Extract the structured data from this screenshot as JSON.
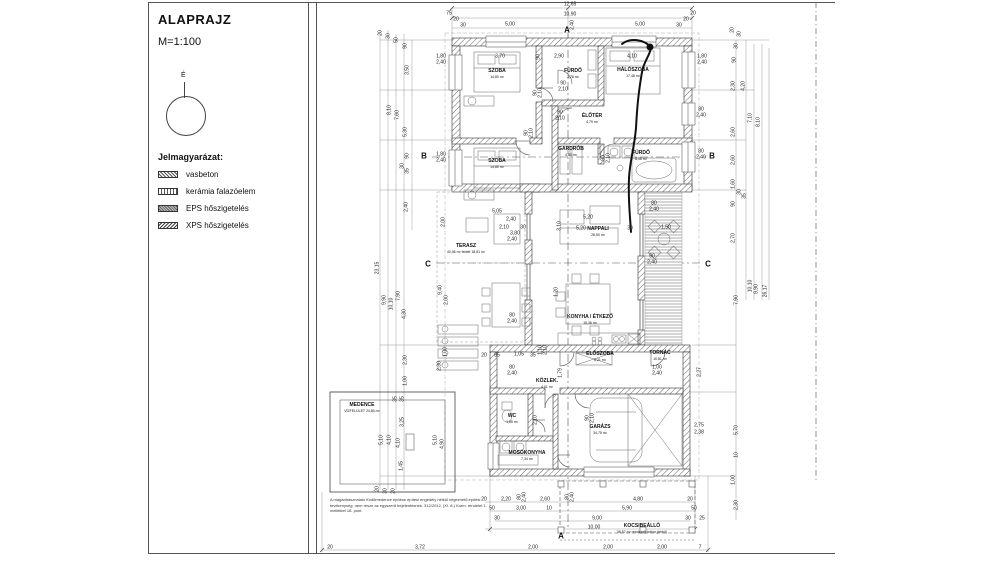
{
  "titleblock": {
    "title": "ALAPRAJZ",
    "scale": "M=1:100",
    "north_label": "É",
    "legend_title": "Jelmagyarázat:",
    "legend": [
      {
        "label": "vasbeton"
      },
      {
        "label": "kerámia falazóelem"
      },
      {
        "label": "EPS hőszigetelés"
      },
      {
        "label": "XPS hőszigetelés"
      }
    ]
  },
  "note": "A magánhasználatú fürdőmedence építése építési engedély nélkül végezhető építési tevékenység, nem része az egyszerű bejelentésnek. 312/2012. (XI. 8.) Korm. rendelet 1. melléklet 18. pont.",
  "rooms": [
    {
      "name": "SZOBA",
      "sub": "14,80 m²",
      "x": 497,
      "y": 74
    },
    {
      "name": "FÜRDŐ",
      "sub": "3,78 m²",
      "x": 573,
      "y": 74
    },
    {
      "name": "HÁLÓSZOBA",
      "sub": "17,48 m²",
      "x": 633,
      "y": 73
    },
    {
      "name": "ÉLŐTÉR",
      "sub": "4,79 m²",
      "x": 592,
      "y": 119
    },
    {
      "name": "GARDRÓB",
      "sub": "4,80 m²",
      "x": 571,
      "y": 152
    },
    {
      "name": "FÜRDŐ",
      "sub": "8,06 m²",
      "x": 641,
      "y": 156
    },
    {
      "name": "SZOBA",
      "sub": "14,80 m²",
      "x": 497,
      "y": 164
    },
    {
      "name": "TERASZ",
      "sub": "40,96 m²  fedett 18,81 m²",
      "x": 466,
      "y": 249
    },
    {
      "name": "NAPPALI",
      "sub": "28,50 m²",
      "x": 598,
      "y": 232
    },
    {
      "name": "KONYHA / ÉTKEZŐ",
      "sub": "15,36 m²",
      "x": 590,
      "y": 320
    },
    {
      "name": "ELŐSZOBA",
      "sub": "6,21 m²",
      "x": 600,
      "y": 357
    },
    {
      "name": "TORNÁC",
      "sub": "10,81 m²",
      "x": 660,
      "y": 356
    },
    {
      "name": "KÖZLEK.",
      "sub": "4,01 m²",
      "x": 547,
      "y": 384
    },
    {
      "name": "WC",
      "sub": "1,85 m²",
      "x": 512,
      "y": 419
    },
    {
      "name": "MOSÓKONYHA",
      "sub": "7,34 m²",
      "x": 527,
      "y": 456
    },
    {
      "name": "GARÁZS",
      "sub": "34,75 m²",
      "x": 600,
      "y": 430
    },
    {
      "name": "KOCSIBEÁLLÓ",
      "sub": "36,57 m²  rendezett beton (térkő)",
      "x": 642,
      "y": 529
    },
    {
      "name": "MEDENCE",
      "sub": "VÍZFELÜLET  24,80 m²",
      "x": 362,
      "y": 408
    }
  ],
  "sections": [
    {
      "label": "B",
      "x": 424,
      "y": 156
    },
    {
      "label": "B",
      "x": 712,
      "y": 156
    },
    {
      "label": "C",
      "x": 428,
      "y": 264
    },
    {
      "label": "C",
      "x": 708,
      "y": 264
    },
    {
      "label": "A",
      "x": 567,
      "y": 30
    },
    {
      "label": "A",
      "x": 561,
      "y": 536
    }
  ],
  "dimensions": [
    {
      "t": "12,65",
      "x": 570,
      "y": 5
    },
    {
      "t": "10,90",
      "x": 570,
      "y": 15
    },
    {
      "t": "5,00",
      "x": 510,
      "y": 25
    },
    {
      "t": "2,40",
      "x": 573,
      "y": 25,
      "v": 1
    },
    {
      "t": "5,00",
      "x": 640,
      "y": 25
    },
    {
      "t": "75",
      "x": 449,
      "y": 14
    },
    {
      "t": "20",
      "x": 456,
      "y": 20
    },
    {
      "t": "30",
      "x": 463,
      "y": 26
    },
    {
      "t": "30",
      "x": 679,
      "y": 26
    },
    {
      "t": "20",
      "x": 686,
      "y": 20
    },
    {
      "t": "20",
      "x": 693,
      "y": 14
    },
    {
      "t": "1,80",
      "x": 441,
      "y": 57
    },
    {
      "t": "2,40",
      "x": 441,
      "y": 63
    },
    {
      "t": "3,70",
      "x": 500,
      "y": 57
    },
    {
      "t": "90",
      "x": 539,
      "y": 57,
      "v": 1
    },
    {
      "t": "2,90",
      "x": 559,
      "y": 57
    },
    {
      "t": "4,10",
      "x": 632,
      "y": 57
    },
    {
      "t": "1,80",
      "x": 702,
      "y": 57
    },
    {
      "t": "2,40",
      "x": 702,
      "y": 63
    },
    {
      "t": "90",
      "x": 536,
      "y": 93,
      "v": 1
    },
    {
      "t": "2,10",
      "x": 541,
      "y": 93,
      "v": 1
    },
    {
      "t": "90",
      "x": 527,
      "y": 133,
      "v": 1
    },
    {
      "t": "2,10",
      "x": 532,
      "y": 133,
      "v": 1
    },
    {
      "t": "80",
      "x": 701,
      "y": 110
    },
    {
      "t": "2,40",
      "x": 701,
      "y": 116
    },
    {
      "t": "90",
      "x": 563,
      "y": 84
    },
    {
      "t": "2,10",
      "x": 563,
      "y": 90
    },
    {
      "t": "90",
      "x": 560,
      "y": 113
    },
    {
      "t": "2,10",
      "x": 560,
      "y": 119
    },
    {
      "t": "1,80",
      "x": 441,
      "y": 155
    },
    {
      "t": "2,40",
      "x": 441,
      "y": 161
    },
    {
      "t": "80",
      "x": 701,
      "y": 152
    },
    {
      "t": "2,40",
      "x": 701,
      "y": 158
    },
    {
      "t": "90",
      "x": 604,
      "y": 158,
      "v": 1
    },
    {
      "t": "2,10",
      "x": 609,
      "y": 158,
      "v": 1
    },
    {
      "t": "5,05",
      "x": 497,
      "y": 212
    },
    {
      "t": "2,40",
      "x": 511,
      "y": 220
    },
    {
      "t": "2,10",
      "x": 504,
      "y": 228
    },
    {
      "t": "30",
      "x": 523,
      "y": 228
    },
    {
      "t": "3,80",
      "x": 515,
      "y": 234
    },
    {
      "t": "2,40",
      "x": 512,
      "y": 240
    },
    {
      "t": "2,00",
      "x": 444,
      "y": 222,
      "v": 1
    },
    {
      "t": "9,40",
      "x": 441,
      "y": 290,
      "v": 1
    },
    {
      "t": "2,00",
      "x": 447,
      "y": 300,
      "v": 1
    },
    {
      "t": "1,00",
      "x": 446,
      "y": 352,
      "v": 1
    },
    {
      "t": "5,20",
      "x": 588,
      "y": 218
    },
    {
      "t": "5,20",
      "x": 581,
      "y": 229
    },
    {
      "t": "30",
      "x": 630,
      "y": 229
    },
    {
      "t": "3,10",
      "x": 560,
      "y": 226,
      "v": 1
    },
    {
      "t": "80",
      "x": 654,
      "y": 204
    },
    {
      "t": "2,40",
      "x": 654,
      "y": 210
    },
    {
      "t": "1,50",
      "x": 666,
      "y": 228
    },
    {
      "t": "90",
      "x": 652,
      "y": 257
    },
    {
      "t": "2,40",
      "x": 652,
      "y": 263
    },
    {
      "t": "80",
      "x": 512,
      "y": 316
    },
    {
      "t": "2,40",
      "x": 512,
      "y": 322
    },
    {
      "t": "1,20",
      "x": 557,
      "y": 292,
      "v": 1
    },
    {
      "t": "20",
      "x": 484,
      "y": 356
    },
    {
      "t": "85",
      "x": 497,
      "y": 356
    },
    {
      "t": "1,05",
      "x": 519,
      "y": 355
    },
    {
      "t": "35",
      "x": 533,
      "y": 356
    },
    {
      "t": "80",
      "x": 512,
      "y": 368
    },
    {
      "t": "2,40",
      "x": 512,
      "y": 374
    },
    {
      "t": "1,10",
      "x": 541,
      "y": 350,
      "v": 1
    },
    {
      "t": "2,10",
      "x": 546,
      "y": 350,
      "v": 1
    },
    {
      "t": "1,79",
      "x": 561,
      "y": 373,
      "v": 1
    },
    {
      "t": "1,00",
      "x": 657,
      "y": 368
    },
    {
      "t": "2,40",
      "x": 657,
      "y": 374
    },
    {
      "t": "2,27",
      "x": 700,
      "y": 372,
      "v": 1
    },
    {
      "t": "90",
      "x": 588,
      "y": 418,
      "v": 1
    },
    {
      "t": "2,10",
      "x": 593,
      "y": 418,
      "v": 1
    },
    {
      "t": "2,10",
      "x": 536,
      "y": 420,
      "v": 1
    },
    {
      "t": "2,75",
      "x": 699,
      "y": 426
    },
    {
      "t": "2,38",
      "x": 699,
      "y": 433
    },
    {
      "t": "20",
      "x": 484,
      "y": 500
    },
    {
      "t": "2,20",
      "x": 506,
      "y": 500
    },
    {
      "t": "80",
      "x": 520,
      "y": 497,
      "v": 1
    },
    {
      "t": "2,40",
      "x": 525,
      "y": 497,
      "v": 1
    },
    {
      "t": "2,60",
      "x": 545,
      "y": 500
    },
    {
      "t": "80",
      "x": 568,
      "y": 497,
      "v": 1
    },
    {
      "t": "2,40",
      "x": 573,
      "y": 497,
      "v": 1
    },
    {
      "t": "4,80",
      "x": 638,
      "y": 500
    },
    {
      "t": "20",
      "x": 690,
      "y": 500
    },
    {
      "t": "50",
      "x": 492,
      "y": 509
    },
    {
      "t": "3,00",
      "x": 521,
      "y": 509
    },
    {
      "t": "10",
      "x": 549,
      "y": 509
    },
    {
      "t": "5,90",
      "x": 627,
      "y": 509
    },
    {
      "t": "50",
      "x": 694,
      "y": 509
    },
    {
      "t": "30",
      "x": 497,
      "y": 519
    },
    {
      "t": "9,00",
      "x": 597,
      "y": 519
    },
    {
      "t": "30",
      "x": 688,
      "y": 519
    },
    {
      "t": "25",
      "x": 702,
      "y": 519
    },
    {
      "t": "10,00",
      "x": 594,
      "y": 528
    },
    {
      "t": "20",
      "x": 330,
      "y": 548
    },
    {
      "t": "3,72",
      "x": 420,
      "y": 548
    },
    {
      "t": "2,00",
      "x": 533,
      "y": 548
    },
    {
      "t": "2,00",
      "x": 608,
      "y": 548
    },
    {
      "t": "2,00",
      "x": 662,
      "y": 548
    },
    {
      "t": "7",
      "x": 700,
      "y": 548
    },
    {
      "t": "35",
      "x": 396,
      "y": 399,
      "v": 1
    },
    {
      "t": "35",
      "x": 403,
      "y": 399,
      "v": 1
    },
    {
      "t": "3,25",
      "x": 403,
      "y": 422,
      "v": 1
    },
    {
      "t": "5,10",
      "x": 382,
      "y": 440,
      "v": 1
    },
    {
      "t": "4,10",
      "x": 390,
      "y": 440,
      "v": 1
    },
    {
      "t": "4,10",
      "x": 399,
      "y": 443,
      "v": 1
    },
    {
      "t": "1,45",
      "x": 402,
      "y": 466,
      "v": 1
    },
    {
      "t": "5,10",
      "x": 436,
      "y": 440,
      "v": 1
    },
    {
      "t": "4,90",
      "x": 443,
      "y": 444,
      "v": 1
    },
    {
      "t": "20",
      "x": 378,
      "y": 489,
      "v": 1
    },
    {
      "t": "30",
      "x": 386,
      "y": 491,
      "v": 1
    },
    {
      "t": "20",
      "x": 394,
      "y": 491,
      "v": 1
    },
    {
      "t": "2,30",
      "x": 440,
      "y": 366,
      "v": 1
    },
    {
      "t": "20",
      "x": 381,
      "y": 33,
      "v": 1
    },
    {
      "t": "30",
      "x": 389,
      "y": 36,
      "v": 1
    },
    {
      "t": "50",
      "x": 397,
      "y": 40,
      "v": 1
    },
    {
      "t": "90",
      "x": 406,
      "y": 46,
      "v": 1
    },
    {
      "t": "3,50",
      "x": 408,
      "y": 70,
      "v": 1
    },
    {
      "t": "8,10",
      "x": 390,
      "y": 110,
      "v": 1
    },
    {
      "t": "7,60",
      "x": 398,
      "y": 115,
      "v": 1
    },
    {
      "t": "5,30",
      "x": 406,
      "y": 132,
      "v": 1
    },
    {
      "t": "90",
      "x": 408,
      "y": 156,
      "v": 1
    },
    {
      "t": "30",
      "x": 403,
      "y": 166,
      "v": 1
    },
    {
      "t": "35",
      "x": 408,
      "y": 171,
      "v": 1
    },
    {
      "t": "2,40",
      "x": 407,
      "y": 207,
      "v": 1
    },
    {
      "t": "23,15",
      "x": 378,
      "y": 268,
      "v": 1
    },
    {
      "t": "9,90",
      "x": 385,
      "y": 300,
      "v": 1
    },
    {
      "t": "10,10",
      "x": 392,
      "y": 304,
      "v": 1
    },
    {
      "t": "7,90",
      "x": 399,
      "y": 296,
      "v": 1
    },
    {
      "t": "4,30",
      "x": 405,
      "y": 314,
      "v": 1
    },
    {
      "t": "2,30",
      "x": 406,
      "y": 360,
      "v": 1
    },
    {
      "t": "1,00",
      "x": 406,
      "y": 381,
      "v": 1
    },
    {
      "t": "20",
      "x": 733,
      "y": 30,
      "v": 1
    },
    {
      "t": "30",
      "x": 740,
      "y": 34,
      "v": 1
    },
    {
      "t": "30",
      "x": 737,
      "y": 46,
      "v": 1
    },
    {
      "t": "90",
      "x": 735,
      "y": 60,
      "v": 1
    },
    {
      "t": "2,30",
      "x": 734,
      "y": 86,
      "v": 1
    },
    {
      "t": "4,20",
      "x": 744,
      "y": 86,
      "v": 1
    },
    {
      "t": "7,10",
      "x": 751,
      "y": 118,
      "v": 1
    },
    {
      "t": "8,10",
      "x": 759,
      "y": 122,
      "v": 1
    },
    {
      "t": "2,60",
      "x": 734,
      "y": 132,
      "v": 1
    },
    {
      "t": "2,60",
      "x": 734,
      "y": 160,
      "v": 1
    },
    {
      "t": "1,60",
      "x": 734,
      "y": 184,
      "v": 1
    },
    {
      "t": "90",
      "x": 734,
      "y": 204,
      "v": 1
    },
    {
      "t": "30",
      "x": 740,
      "y": 192,
      "v": 1
    },
    {
      "t": "35",
      "x": 745,
      "y": 196,
      "v": 1
    },
    {
      "t": "2,70",
      "x": 734,
      "y": 238,
      "v": 1
    },
    {
      "t": "7,90",
      "x": 737,
      "y": 300,
      "v": 1
    },
    {
      "t": "10,10",
      "x": 751,
      "y": 286,
      "v": 1
    },
    {
      "t": "9,90",
      "x": 757,
      "y": 289,
      "v": 1
    },
    {
      "t": "26,17",
      "x": 766,
      "y": 291,
      "v": 1
    },
    {
      "t": "5,70",
      "x": 737,
      "y": 430,
      "v": 1
    },
    {
      "t": "10",
      "x": 737,
      "y": 455,
      "v": 1
    },
    {
      "t": "1,00",
      "x": 734,
      "y": 480,
      "v": 1
    },
    {
      "t": "2,30",
      "x": 737,
      "y": 505,
      "v": 1
    }
  ]
}
